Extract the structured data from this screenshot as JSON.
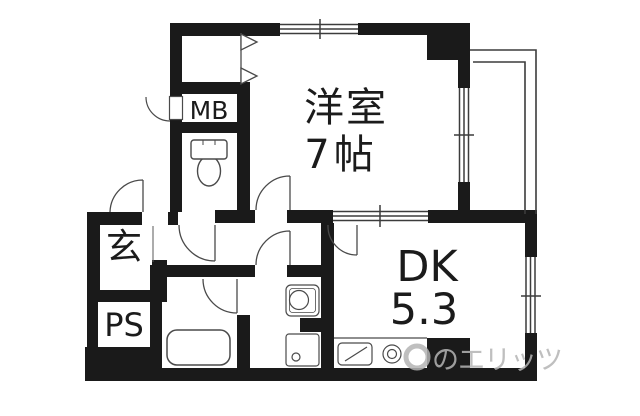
{
  "plan": {
    "type": "apartment-floor-plan",
    "rooms": {
      "western_room": {
        "name": "洋室",
        "size": "7帖"
      },
      "dining_kitchen": {
        "name": "DK",
        "size": "5.3"
      },
      "entrance": {
        "label": "玄"
      },
      "pipe_space": {
        "label": "PS"
      },
      "meter_box": {
        "label": "MB"
      }
    },
    "watermark": {
      "text": "のエリッツ"
    },
    "icons": [
      "toilet-icon",
      "bathtub-icon",
      "washbasin-icon",
      "washing-machine-pan-icon",
      "kitchen-sink-icon",
      "stove-burner-icon",
      "door-swing-icon",
      "folding-door-icon",
      "window-icon",
      "balcony-icon",
      "meter-box-door-icon",
      "brand-logo-icon"
    ],
    "colors": {
      "wall": "#1a1a1a",
      "line": "#3c3c3c",
      "fixture": "#4a4a4a",
      "watermark": "#b4b4b4",
      "background": "#ffffff",
      "text": "#1b1b1b"
    }
  }
}
